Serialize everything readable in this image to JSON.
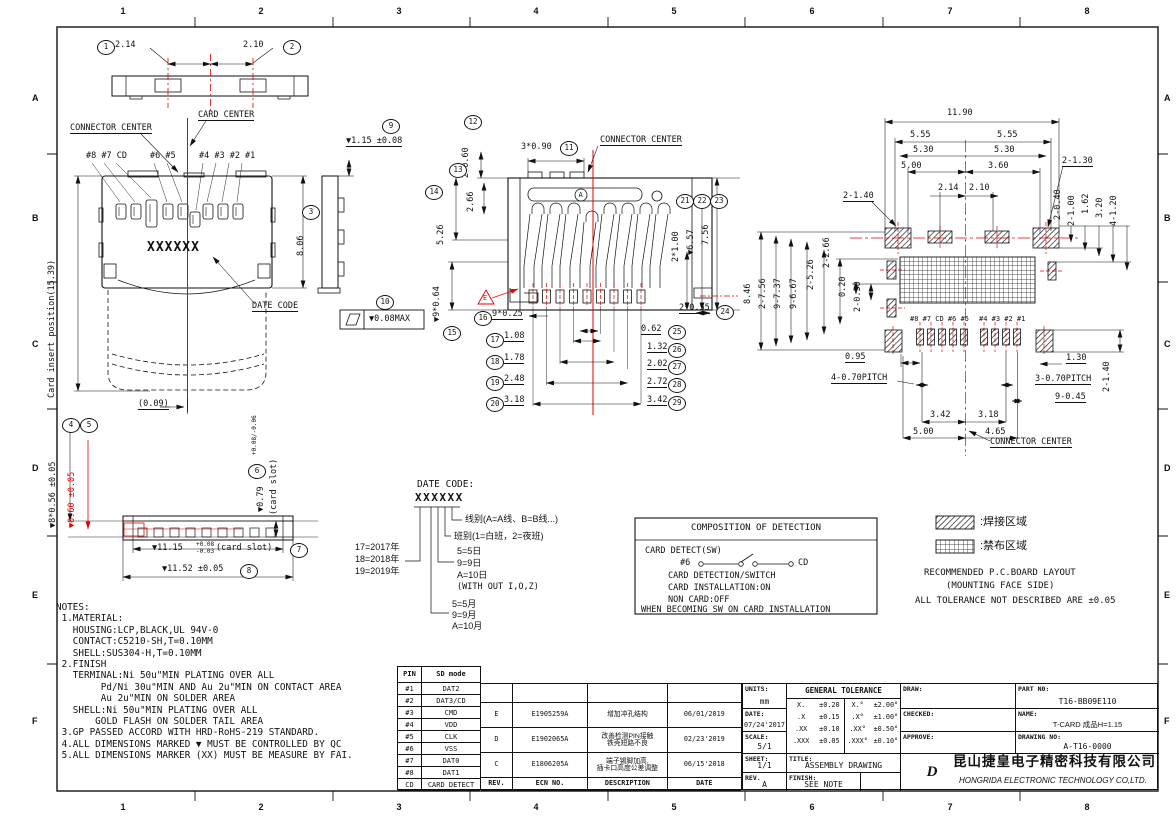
{
  "frame": {
    "columns": [
      "1",
      "2",
      "3",
      "4",
      "5",
      "6",
      "7",
      "8"
    ],
    "rows": [
      "A",
      "B",
      "C",
      "D",
      "E",
      "F"
    ]
  },
  "colors": {
    "accent_red": "#e60000",
    "line": "#111111"
  },
  "views": {
    "top_profile": {
      "d1": {
        "n": "1",
        "t": "2.14"
      },
      "d2": {
        "n": "2",
        "t": "2.10"
      }
    },
    "front": {
      "connector_center": "CONNECTOR CENTER",
      "card_center": "CARD CENTER",
      "pins_left": "#8 #7 CD",
      "pins_mid": "#6 #5",
      "pins_right": "#4 #3 #2 #1",
      "card_insert": "Card insert position(15.39)",
      "height": {
        "n": "3",
        "t": "8.06"
      },
      "date_code_text": "XXXXXX",
      "date_code_label": "DATE CODE",
      "bottom_offset": "(0.09)"
    },
    "side": {
      "d9": {
        "n": "9",
        "t": "▼1.15 ±0.08"
      },
      "d10": {
        "n": "10",
        "t": "▼0.08MAX"
      }
    },
    "middle": {
      "connector_center": "CONNECTOR CENTER",
      "marker_a": "A",
      "marker_e": "E",
      "d11": {
        "n": "11",
        "t": "3*0.90"
      },
      "d12": {
        "n": "12",
        "t": "2*0.60"
      },
      "d13": {
        "n": "13",
        "t": "2.66"
      },
      "d14": {
        "n": "14",
        "t": "5.26"
      },
      "d15": {
        "n": "15",
        "t": "▼9*0.64"
      },
      "d16": {
        "n": "16",
        "t": "9*0.25"
      },
      "d17": {
        "n": "17",
        "t": "1.08"
      },
      "d18": {
        "n": "18",
        "t": "1.78"
      },
      "d19": {
        "n": "19",
        "t": "2.48"
      },
      "d20": {
        "n": "20",
        "t": "3.18"
      },
      "d21": {
        "n": "21",
        "t": "2*1.00"
      },
      "d22": {
        "n": "22",
        "t": "▼6.57"
      },
      "d23": {
        "n": "23",
        "t": "7.56"
      },
      "d24": {
        "n": "24",
        "t": "2*0.55"
      },
      "d25": {
        "n": "25",
        "t": "0.62"
      },
      "d26": {
        "n": "26",
        "t": "1.32"
      },
      "d27": {
        "n": "27",
        "t": "2.02"
      },
      "d28": {
        "n": "28",
        "t": "2.72"
      },
      "d29": {
        "n": "29",
        "t": "3.42"
      }
    },
    "bottom_profile": {
      "d4": {
        "n": "4",
        "t": "▼8*0.56 ±0.05"
      },
      "d5": {
        "n": "5",
        "t": "▼0.60 ±0.05"
      },
      "d6": {
        "n": "6",
        "t": "▼0.79",
        "tol": "+0.08/-0.06",
        "suffix": "(card slot)"
      },
      "d7": {
        "n": "7",
        "t": "▼11.15",
        "tol_top": "+0.08",
        "tol_bot": "-0.03",
        "suffix": "(card slot)"
      },
      "d8": {
        "n": "8",
        "t": "▼11.52 ±0.05"
      }
    },
    "pcb": {
      "top_dims": [
        "11.90",
        "5.55",
        "5.55",
        "5.30",
        "5.30",
        "5.00",
        "3.60",
        "2-1.30",
        "2.14",
        "2.10",
        "2-1.40"
      ],
      "right_dims": [
        "2-0.40",
        "2-1.00",
        "1.62",
        "3.20",
        "4-1.20"
      ],
      "left_dims": [
        "8.46",
        "2-7.56",
        "9-7.37",
        "9-6.67",
        "2-5.26",
        "2-2.66",
        "0.20",
        "2-0.30"
      ],
      "bottom_dims": [
        "0.95",
        "4-0.70PITCH",
        "3.42",
        "3.18",
        "5.00",
        "4.65",
        "1.30",
        "3-0.70PITCH",
        "9-0.45",
        "2-1.40"
      ],
      "pad_labels_left": "#8 #7 CD #6 #5",
      "pad_labels_right": "#4 #3 #2 #1",
      "connector_center": "CONNECTOR CENTER"
    }
  },
  "legend": {
    "solder": ":焊接区域",
    "keepout": ":禁布区域",
    "note1": "RECOMMENDED P.C.BOARD LAYOUT",
    "note2": "(MOUNTING FACE SIDE)",
    "note3": "ALL TOLERANCE NOT DESCRIBED ARE ±0.05"
  },
  "detection": {
    "title": "COMPOSITION OF DETECTION",
    "line1": "CARD DETECT(SW)",
    "sw_left": "#6",
    "sw_right": "CD",
    "line2": "CARD DETECTION/SWITCH",
    "line3": "CARD INSTALLATION:ON",
    "line4": "NON CARD:OFF",
    "line5": "WHEN BECOMING SW ON CARD INSTALLATION"
  },
  "date_code": {
    "title": "DATE CODE:",
    "code": "XXXXXX",
    "line_type": "线别(A=A线、B=B线...)",
    "shift": "班别(1=白班，2=夜班)",
    "day": [
      "5=5日",
      "9=9日",
      "A=10日",
      "(WITH OUT I,O,Z)"
    ],
    "year": [
      "17=2017年",
      "18=2018年",
      "19=2019年"
    ],
    "month": [
      "5=5月",
      "9=9月",
      "A=10月"
    ]
  },
  "notes_lines": [
    "NOTES:",
    " 1.MATERIAL:",
    "   HOUSING:LCP,BLACK,UL 94V-0",
    "   CONTACT:C5210-SH,T=0.10MM",
    "   SHELL:SUS304-H,T=0.10MM",
    " 2.FINISH",
    "   TERMINAL:Ni 50u\"MIN PLATING OVER ALL",
    "        Pd/Ni 30u\"MIN AND Au 2u\"MIN ON CONTACT AREA",
    "        Au 2u\"MIN ON SOLDER AREA",
    "   SHELL:Ni 50u\"MIN PLATING OVER ALL",
    "       GOLD FLASH ON SOLDER TAIL AREA",
    " 3.GP PASSED ACCORD WITH HRD-RoHS-219 STANDARD.",
    " 4.ALL DIMENSIONS MARKED ▼ MUST BE CONTROLLED BY QC",
    " 5.ALL DIMENSIONS MARKER (XX) MUST BE MEASURE BY FAI."
  ],
  "pin_table": {
    "headers": [
      "PIN",
      "SD mode"
    ],
    "rows": [
      [
        "#1",
        "DAT2"
      ],
      [
        "#2",
        "DAT3/CD"
      ],
      [
        "#3",
        "CMD"
      ],
      [
        "#4",
        "VDD"
      ],
      [
        "#5",
        "CLK"
      ],
      [
        "#6",
        "VSS"
      ],
      [
        "#7",
        "DAT0"
      ],
      [
        "#8",
        "DAT1"
      ],
      [
        "CD",
        "CARD DETECT"
      ]
    ]
  },
  "revisions": {
    "headers": [
      "REV.",
      "ECN NO.",
      "DESCRIPTION",
      "DATE"
    ],
    "rows": [
      [
        "E",
        "E1905259A",
        "增加冲孔结构",
        "06/01/2019"
      ],
      [
        "D",
        "E1902065A",
        "改善检测PIN接触\n铁壳短路不良",
        "02/23'2019"
      ],
      [
        "C",
        "E1806205A",
        "端子锡脚加高,\n插卡口高度公差调整",
        "06/15'2018"
      ]
    ]
  },
  "title_block": {
    "units_label": "UNITS:",
    "units": "mm",
    "date_label": "DATE:",
    "date": "07/24'2017",
    "scale_label": "SCALE:",
    "scale": "5/1",
    "sheet_label": "SHEET:",
    "sheet": "1/1",
    "rev_label": "REV.",
    "rev": "A",
    "tolerance_title": "GENERAL TOLERANCE",
    "tolerance_rows": [
      [
        "X.",
        "±0.20",
        "X.°",
        "±2.00°"
      ],
      [
        ".X",
        "±0.15",
        ".X°",
        "±1.00°"
      ],
      [
        ".XX",
        "±0.10",
        ".XX°",
        "±0.50°"
      ],
      [
        ".XXX",
        "±0.05",
        ".XXX°",
        "±0.10°"
      ]
    ],
    "title_label": "TITLE:",
    "title": "ASSEMBLY DRAWING",
    "finish_label": "FINISH:",
    "finish": "SEE NOTE",
    "draw_label": "DRAW:",
    "checked_label": "CHECKED:",
    "approve_label": "APPROVE:",
    "part_label": "PART N0:",
    "part_no": "T16-BB09E110",
    "name_label": "NAME:",
    "name": "T-CARD 成品H=1.15",
    "drawing_label": "DRAWING NO:",
    "drawing_no": "A-T16-0000",
    "logo_text": "D",
    "company_cn": "昆山捷皇电子精密科技有限公司",
    "company_en": "HONGRIDA ELECTRONIC TECHNOLOGY CO,LTD."
  }
}
